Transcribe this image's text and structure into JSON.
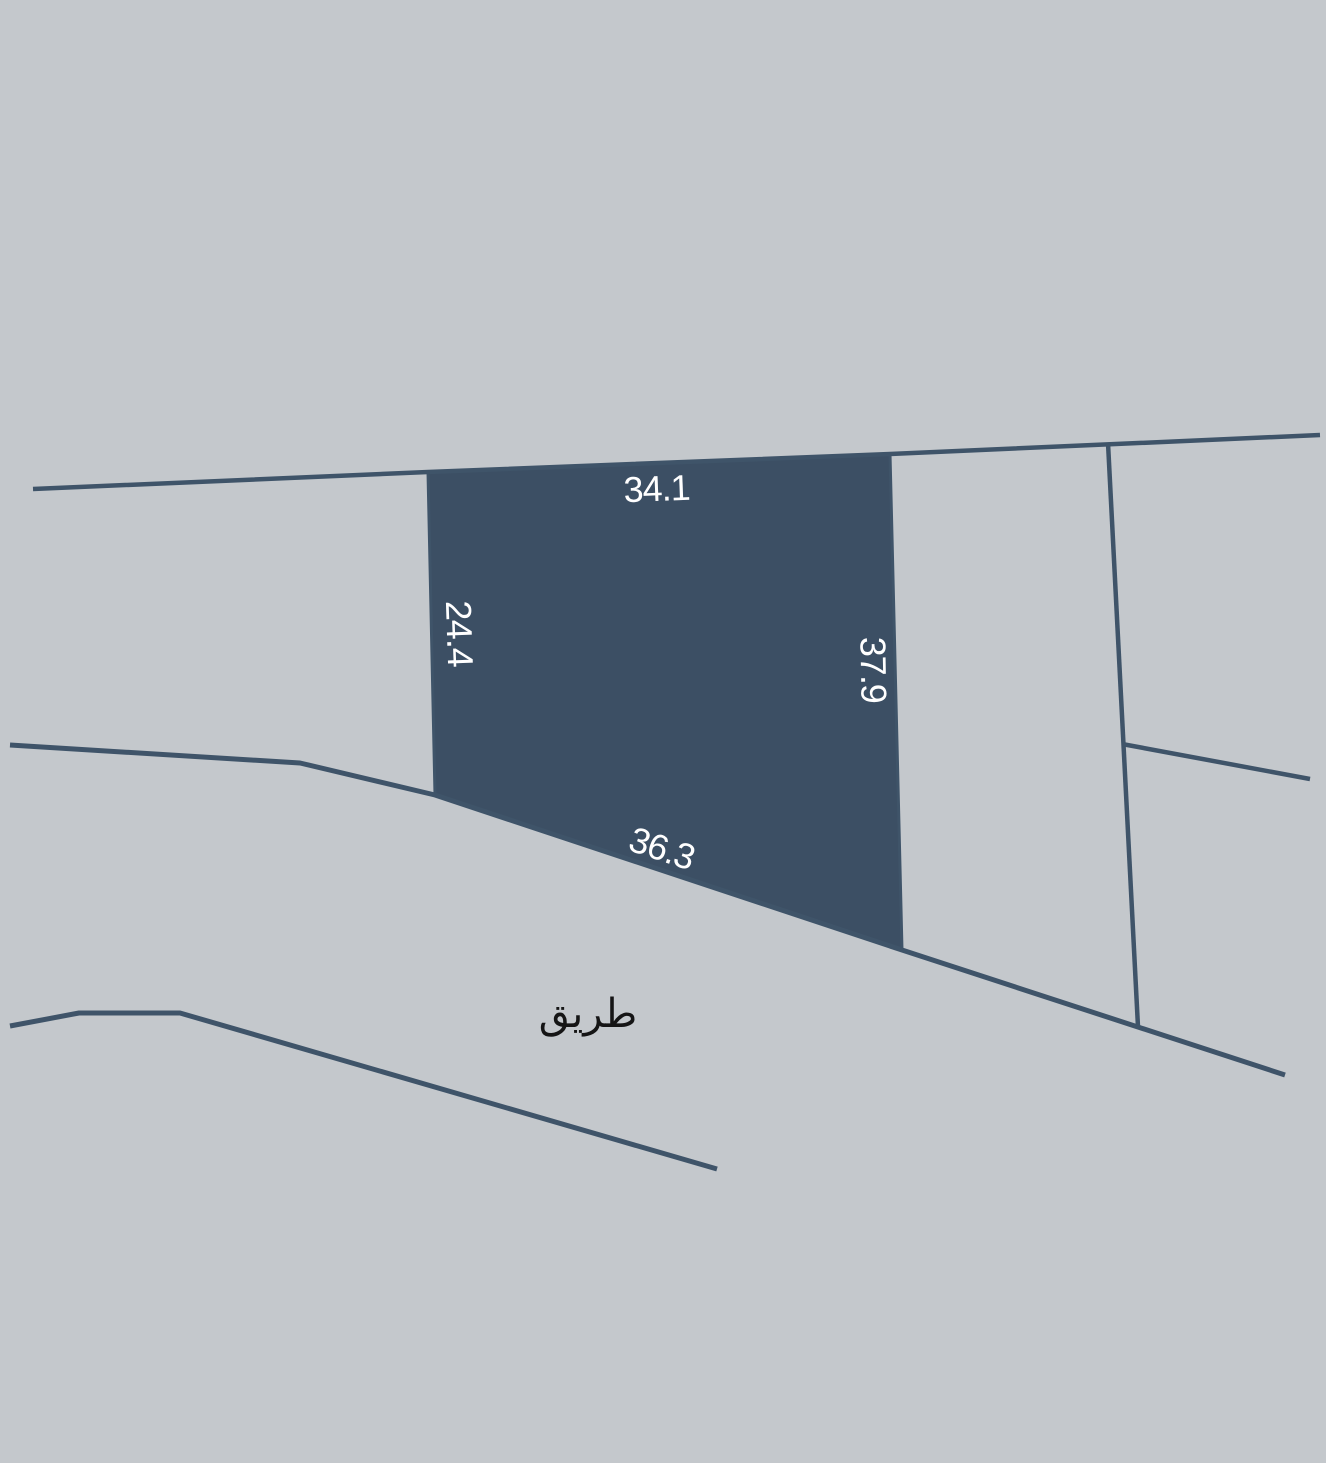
{
  "map": {
    "road_label": "طريق",
    "parcel": {
      "dimension_labels": {
        "top": "34.1",
        "left": "24.4",
        "right": "37.9",
        "bottom": "36.3"
      }
    },
    "colors": {
      "background": "#c4c8cc",
      "parcel_fill": "#3c4f64",
      "boundary_line": "#3f5469",
      "dimension_text": "#ffffff",
      "road_text": "#151515"
    }
  }
}
